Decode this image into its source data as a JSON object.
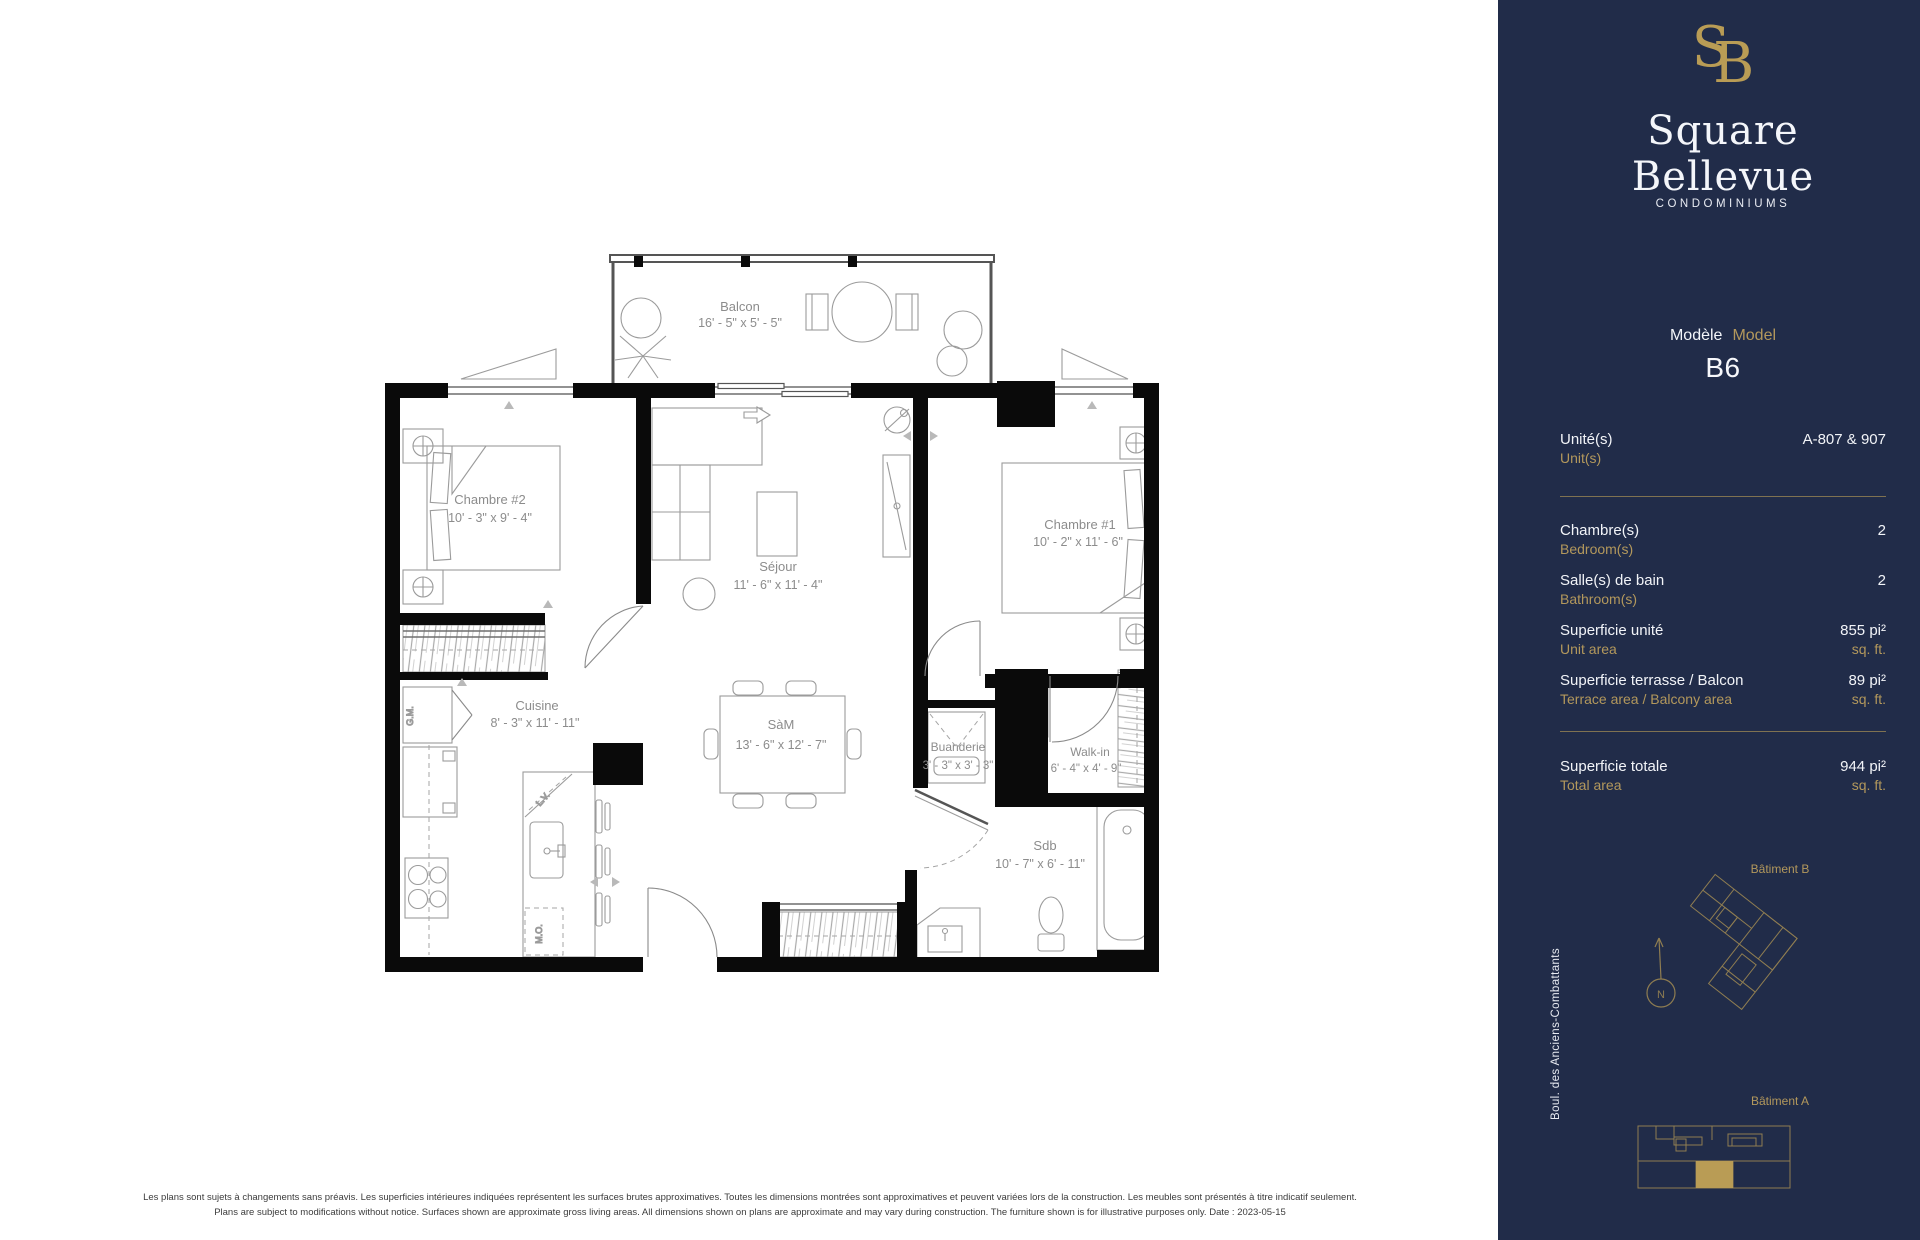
{
  "sidebar": {
    "monogram_s": "S",
    "monogram_b": "B",
    "brand": "Square Bellevue",
    "brand_subtitle": "CONDOMINIUMS",
    "model": {
      "fr": "Modèle",
      "en": "Model",
      "value": "B6"
    },
    "unit": {
      "fr": "Unité(s)",
      "en": "Unit(s)",
      "value": "A-807 & 907"
    },
    "bedrooms": {
      "fr": "Chambre(s)",
      "en": "Bedroom(s)",
      "value": "2"
    },
    "bathrooms": {
      "fr": "Salle(s) de bain",
      "en": "Bathroom(s)",
      "value": "2"
    },
    "unit_area": {
      "fr": "Superficie unité",
      "en": "Unit area",
      "value": "855 pi²",
      "unit_en": "sq. ft."
    },
    "terrace_area": {
      "fr": "Superficie terrasse / Balcon",
      "en": "Terrace area / Balcony area",
      "value": "89 pi²",
      "unit_en": "sq. ft."
    },
    "total_area": {
      "fr": "Superficie totale",
      "en": "Total area",
      "value": "944 pi²",
      "unit_en": "sq. ft."
    },
    "building_b_label": "Bâtiment B",
    "building_a_label": "Bâtiment A",
    "street_label": "Boul. des Anciens-Combattants",
    "compass_n": "N",
    "colors": {
      "navy": "#212c49",
      "gold": "#b3985c",
      "gold_fill": "#b99c55"
    }
  },
  "plan": {
    "rooms": {
      "balcon": {
        "name": "Balcon",
        "dims": "16' - 5\" x 5' - 5\""
      },
      "chambre2": {
        "name": "Chambre #2",
        "dims": "10' - 3\" x 9' - 4\""
      },
      "sejour": {
        "name": "Séjour",
        "dims": "11' - 6\" x 11' - 4\""
      },
      "chambre1": {
        "name": "Chambre #1",
        "dims": "10' - 2\" x 11' - 6\""
      },
      "cuisine": {
        "name": "Cuisine",
        "dims": "8' - 3\" x 11' - 11\""
      },
      "sam": {
        "name": "SàM",
        "dims": "13' - 6\" x 12' - 7\""
      },
      "buanderie": {
        "name": "Buanderie",
        "dims": "3' - 3\" x 3' - 3\""
      },
      "walkin": {
        "name": "Walk-in",
        "dims": "6' - 4\" x 4' - 9\""
      },
      "sdb": {
        "name": "Sdb",
        "dims": "10' - 7\" x 6' - 11\""
      }
    },
    "appliances": {
      "fridge": "G.M.",
      "dishwasher": "L.V.",
      "microwave": "M.O."
    }
  },
  "footer": {
    "line_fr": "Les plans sont sujets à changements sans préavis. Les superficies intérieures indiquées représentent les surfaces brutes approximatives. Toutes les dimensions montrées sont approximatives et peuvent variées lors de la construction. Les meubles sont présentés à titre indicatif seulement.",
    "line_en": "Plans are subject to modifications without notice. Surfaces shown are approximate gross living areas. All dimensions shown on plans are approximate and may vary during construction. The furniture shown is for illustrative purposes only. Date : 2023-05-15"
  }
}
